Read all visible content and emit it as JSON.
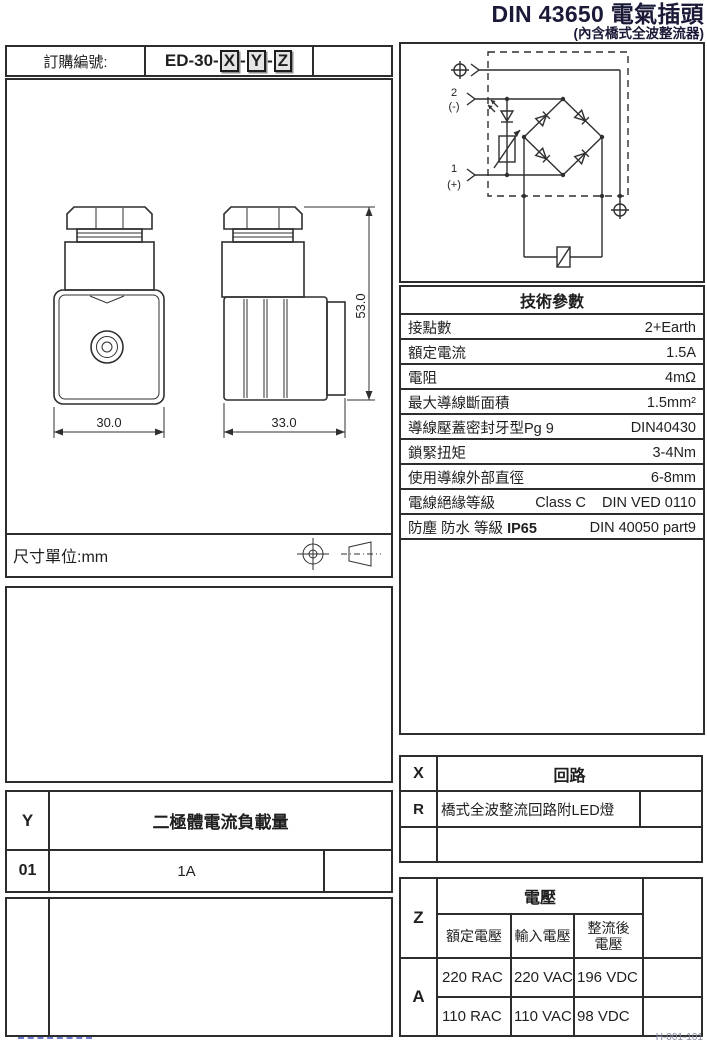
{
  "title": {
    "main": "DIN 43650 電氣插頭",
    "sub": "(內含橋式全波整流器)"
  },
  "order": {
    "label": "訂購編號:",
    "prefix": "ED-30-",
    "x": "X",
    "y": "Y",
    "z": "Z",
    "sep": "-"
  },
  "drawing": {
    "front_width": "30.0",
    "side_width": "33.0",
    "height": "53.0",
    "unit_label": "尺寸單位:mm"
  },
  "circuit": {
    "t2_num": "2",
    "t2_sign": "(-)",
    "t1_num": "1",
    "t1_sign": "(+)"
  },
  "tech": {
    "header": "技術參數",
    "rows": [
      {
        "label": "接點數",
        "value": "2+Earth"
      },
      {
        "label": "額定電流",
        "value": "1.5A"
      },
      {
        "label": "電阻",
        "value": "4mΩ"
      },
      {
        "label": "最大導線斷面積",
        "value": "1.5mm²"
      },
      {
        "label": "導線壓蓋密封牙型Pg 9",
        "value": "DIN40430"
      },
      {
        "label": "鎖緊扭矩",
        "value": "3-4Nm"
      },
      {
        "label": "使用導線外部直徑",
        "value": "6-8mm"
      },
      {
        "label": "電線絕緣等級",
        "mid": "Class C",
        "value": "DIN VED 0110"
      },
      {
        "label": "防塵 防水 等級 ",
        "label_bold": "IP65",
        "value": "DIN 40050 part9"
      }
    ]
  },
  "xtable": {
    "code": "X",
    "header": "回路",
    "row_code": "R",
    "row_desc": "橋式全波整流回路附LED燈"
  },
  "ytable": {
    "code": "Y",
    "header": "二極體電流負載量",
    "row_code": "01",
    "row_value": "1A"
  },
  "ztable": {
    "code": "Z",
    "header": "電壓",
    "col1": "額定電壓",
    "col2": "輸入電壓",
    "col3a": "整流後",
    "col3b": "電壓",
    "row_code": "A",
    "r1c1": "220 RAC",
    "r1c2": "220 VAC",
    "r1c3": "196 VDC",
    "r2c1": "110 RAC",
    "r2c2": "110 VAC",
    "r2c3": "98 VDC"
  },
  "footer": {
    "right": "H-001-101"
  }
}
